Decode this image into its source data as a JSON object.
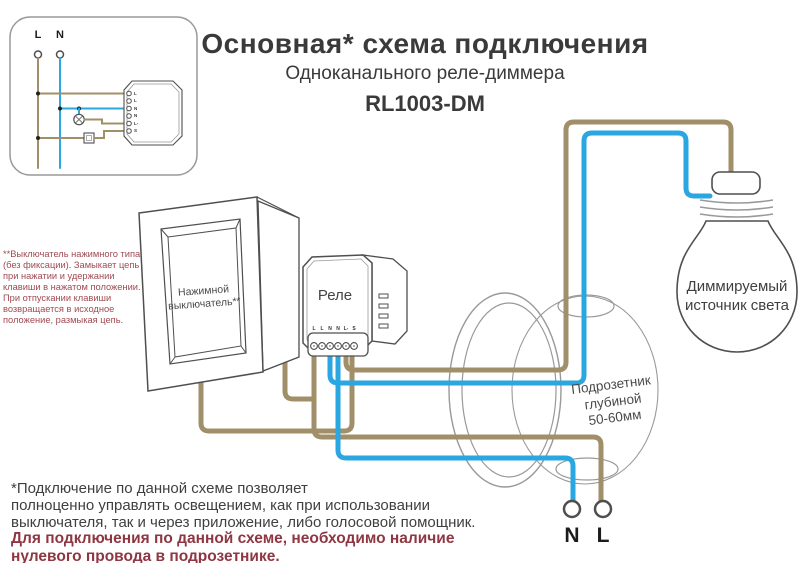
{
  "colors": {
    "wire_brown": "#a08f68",
    "wire_blue": "#2aa7e0",
    "note_red": "#a04a52",
    "warning_red": "#8e3742",
    "text_dark": "#3a3a3a",
    "outline_gray": "#4f4f4f"
  },
  "header": {
    "title": "Основная* схема подключения",
    "subtitle": "Одноканального реле-диммера",
    "model": "RL1003-DM"
  },
  "inset": {
    "l_label": "L",
    "n_label": "N",
    "terminals": [
      "L",
      "L",
      "N",
      "N",
      "L-",
      "S"
    ]
  },
  "switch": {
    "label": "Нажимной\nвыключатель**"
  },
  "relay": {
    "label": "Реле",
    "terminals": [
      "L",
      "L",
      "N",
      "N",
      "L-",
      "S"
    ]
  },
  "mounting_box": {
    "label": "Подрозетник\nглубиной\n50-60мм"
  },
  "bulb": {
    "label": "Диммируемый\nисточник света"
  },
  "mains": {
    "n_label": "N",
    "l_label": "L"
  },
  "notes": {
    "switch_note": "**Выключатель нажимного типа\n(без фиксации). Замыкает цепь\nпри нажатии и удержании\nклавиши в нажатом положении.\nПри отпускании клавиши\nвозвращается в исходное\nположение, размыкая цепь.",
    "footnote": "*Подключение по данной схеме позволяет\nполноценно управлять освещением, как при использовании\nвыключателя, так и через приложение, либо голосовой помощник.",
    "warning": "Для подключения по данной схеме, необходимо наличие\nнулевого провода в подрозетнике."
  }
}
